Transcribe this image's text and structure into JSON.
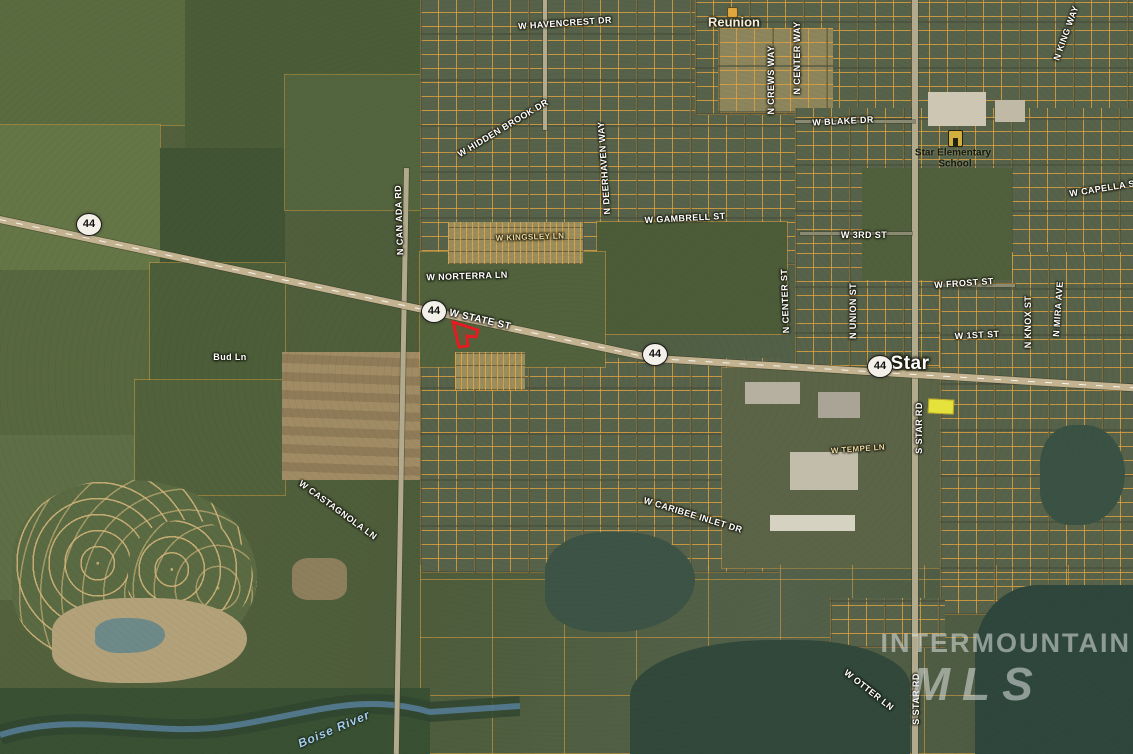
{
  "map": {
    "city_label": {
      "text": "Star",
      "x": 910,
      "y": 364
    },
    "place_label": {
      "text": "Reunion",
      "x": 734,
      "y": 22
    },
    "river_label": {
      "text": "Boise River",
      "x": 334,
      "y": 729,
      "rot": -23
    },
    "school_label": {
      "line1": "Star Elementary",
      "line2": "School"
    },
    "watermark": {
      "line1": "INTERMOUNTAIN",
      "line2": "MLS"
    },
    "highway_shields": [
      {
        "number": "44",
        "x": 88,
        "y": 223
      },
      {
        "number": "44",
        "x": 433,
        "y": 310
      },
      {
        "number": "44",
        "x": 654,
        "y": 353
      },
      {
        "number": "44",
        "x": 879,
        "y": 365
      }
    ],
    "street_labels": [
      {
        "text": "W HAVENCREST DR",
        "x": 565,
        "y": 23,
        "rot": -4
      },
      {
        "text": "W HIDDEN BROOK DR",
        "x": 503,
        "y": 128,
        "rot": -31
      },
      {
        "text": "N DEERHAVEN WAY",
        "x": 604,
        "y": 168,
        "rot": -94
      },
      {
        "text": "W GAMBRELL ST",
        "x": 685,
        "y": 218,
        "rot": -3
      },
      {
        "text": "W KINGSLEY LN",
        "x": 530,
        "y": 237,
        "rot": -2,
        "tone": "tan",
        "size": 8
      },
      {
        "text": "W NORTERRA LN",
        "x": 467,
        "y": 276,
        "rot": -2
      },
      {
        "text": "N CAN ADA RD",
        "x": 399,
        "y": 220,
        "rot": -92
      },
      {
        "text": "N CREWS WAY",
        "x": 771,
        "y": 80,
        "rot": -90
      },
      {
        "text": "N CENTER WAY",
        "x": 797,
        "y": 58,
        "rot": -90
      },
      {
        "text": "N KING WAY",
        "x": 1066,
        "y": 33,
        "rot": -70
      },
      {
        "text": "W BLAKE DR",
        "x": 843,
        "y": 121,
        "rot": -3
      },
      {
        "text": "W 3RD ST",
        "x": 864,
        "y": 235,
        "rot": 0
      },
      {
        "text": "W CAPELLA ST",
        "x": 1105,
        "y": 188,
        "rot": -9
      },
      {
        "text": "W FROST ST",
        "x": 964,
        "y": 283,
        "rot": -4
      },
      {
        "text": "W 1ST ST",
        "x": 977,
        "y": 335,
        "rot": -3
      },
      {
        "text": "N KNOX ST",
        "x": 1028,
        "y": 322,
        "rot": -90
      },
      {
        "text": "N MIRA AVE",
        "x": 1058,
        "y": 309,
        "rot": -86
      },
      {
        "text": "N CENTER ST",
        "x": 785,
        "y": 301,
        "rot": -92
      },
      {
        "text": "N UNION ST",
        "x": 853,
        "y": 311,
        "rot": -90
      },
      {
        "text": "W STATE ST",
        "x": 480,
        "y": 320,
        "rot": 13,
        "size": 10
      },
      {
        "text": "Bud Ln",
        "x": 230,
        "y": 357,
        "rot": 0
      },
      {
        "text": "W TEMPE LN",
        "x": 858,
        "y": 449,
        "rot": -4,
        "tone": "tan",
        "size": 8
      },
      {
        "text": "S STAR RD",
        "x": 919,
        "y": 428,
        "rot": -90
      },
      {
        "text": "W CASTAGNOLA LN",
        "x": 338,
        "y": 510,
        "rot": 36
      },
      {
        "text": "W CARIBEE INLET DR",
        "x": 693,
        "y": 515,
        "rot": 17
      },
      {
        "text": "W OTTER LN",
        "x": 869,
        "y": 690,
        "rot": 38
      },
      {
        "text": "S STAR RD",
        "x": 916,
        "y": 699,
        "rot": -90
      }
    ],
    "subject_parcel": {
      "points": "453,322 478,330 476,337 467,336 468,346 459,347",
      "outline_color": "#e8191f"
    },
    "colors": {
      "parcel_line": "#e3a33e",
      "subject_outline": "#e8191f",
      "road_fill": "#c3b391",
      "water": "#31483a",
      "watermark_text": "rgba(222,226,224,0.55)",
      "street_label": "#ffffff",
      "river_label": "#a6cdf0"
    }
  }
}
